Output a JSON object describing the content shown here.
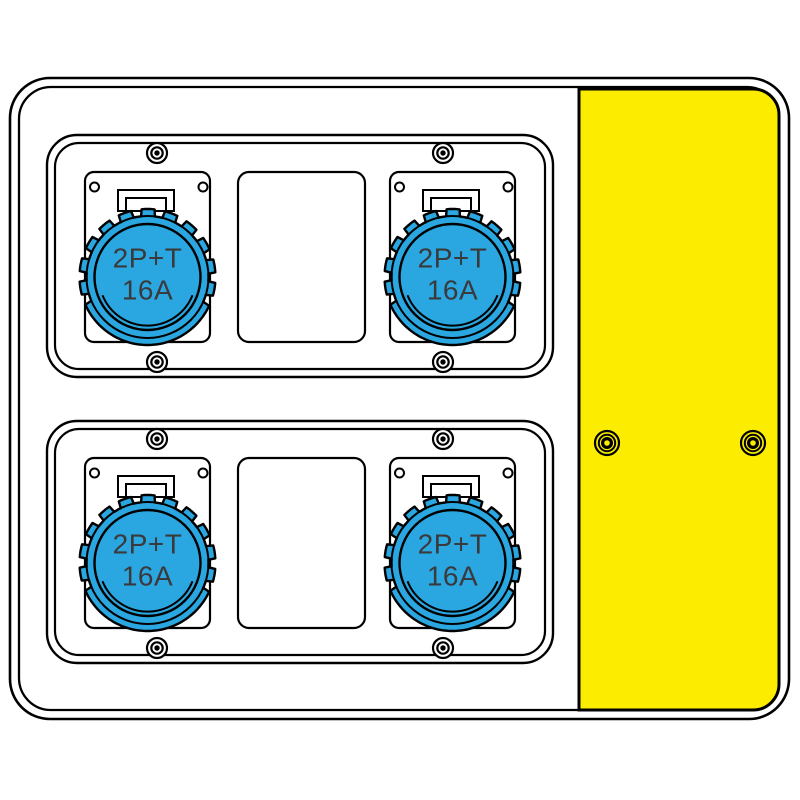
{
  "colors": {
    "background": "#ffffff",
    "line": "#000000",
    "socket_blue": "#2aa7e0",
    "cover_yellow": "#fcec00",
    "label_text": "#3a3a3c"
  },
  "enclosure": {
    "socket_panels": [
      {
        "id": "top",
        "screw_count": 4,
        "modules": [
          {
            "type": "socket",
            "label": {
              "line1": "2P+T",
              "line2": "16A"
            }
          },
          {
            "type": "blank_cover"
          },
          {
            "type": "socket",
            "label": {
              "line1": "2P+T",
              "line2": "16A"
            }
          }
        ]
      },
      {
        "id": "bottom",
        "screw_count": 4,
        "modules": [
          {
            "type": "socket",
            "label": {
              "line1": "2P+T",
              "line2": "16A"
            }
          },
          {
            "type": "blank_cover"
          },
          {
            "type": "socket",
            "label": {
              "line1": "2P+T",
              "line2": "16A"
            }
          }
        ]
      }
    ],
    "side_cover": {
      "screw_count": 2
    }
  }
}
